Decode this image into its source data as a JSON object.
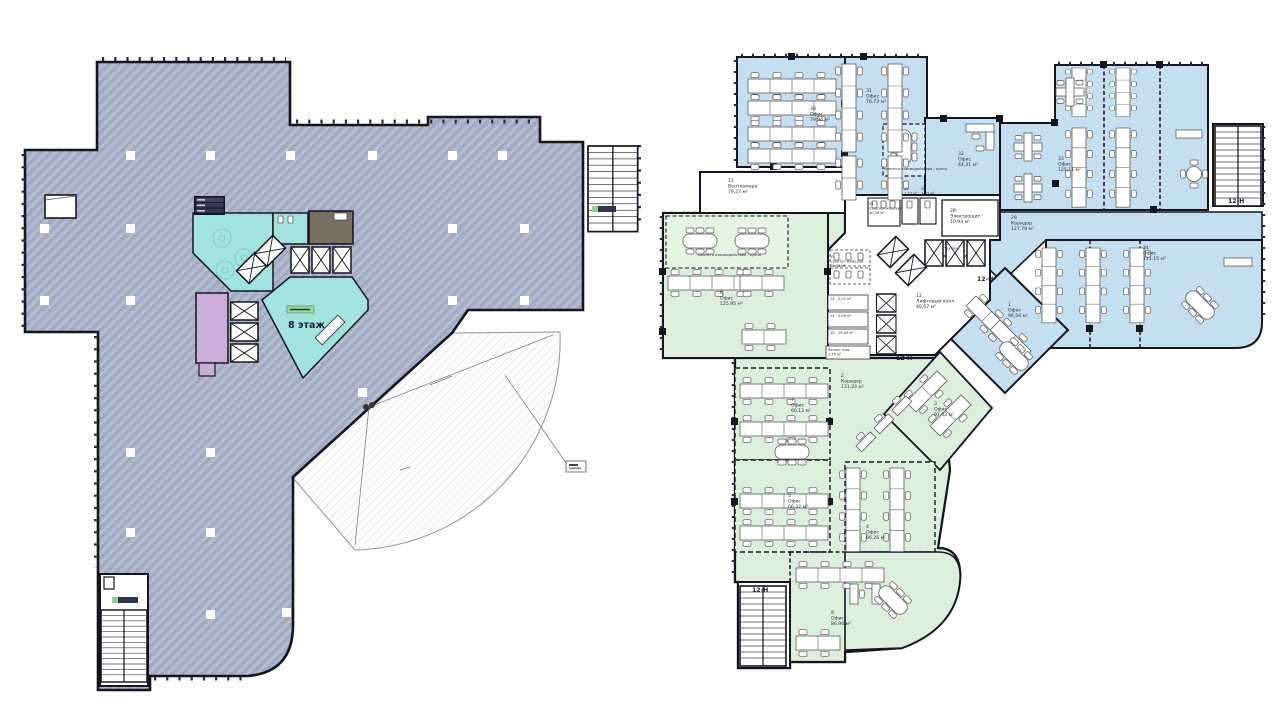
{
  "left_plan": {
    "floor_label": "8 этаж",
    "colors": {
      "body": "#a9b2c8",
      "lobby_teal": "#a2e3dd",
      "room_purple": "#c9afd8",
      "room_brown": "#7b6f64",
      "badge_green": "#98d7a2"
    }
  },
  "right_plan": {
    "colors": {
      "office_blue": "#c6dff0",
      "office_green": "#dcefdc"
    },
    "block_label": "12-Н",
    "meeting_label": "комната взаимодействия / кухня",
    "rooms": {
      "r30": {
        "num": "30",
        "name": "Офис",
        "area": "79,96 м²"
      },
      "r31": {
        "num": "31",
        "name": "Офис",
        "area": "76,73 м²"
      },
      "r32": {
        "num": "32",
        "name": "Офис",
        "area": "44,31 м²"
      },
      "r33": {
        "num": "33",
        "name": "Офис",
        "area": "125,11 м²"
      },
      "r34": {
        "num": "34",
        "name": "Офис",
        "area": "111,15 м²"
      },
      "r29": {
        "num": "29",
        "name": "Коридор",
        "area": "127,79 м²"
      },
      "r11": {
        "num": "11",
        "name": "Венткамера",
        "area": "79,27 м²"
      },
      "r24": {
        "num": "24",
        "name": "Санузел женский",
        "area": "10,16 м²"
      },
      "r25": {
        "num": "25",
        "name": "",
        "area": "1,73 м²"
      },
      "r26": {
        "num": "26",
        "name": "",
        "area": "1,73 м²"
      },
      "r28": {
        "num": "28",
        "name": "Электрощит.",
        "area": "10,94 м²"
      },
      "r27": {
        "num": "27",
        "name": "Тех.пом.",
        "area": ""
      },
      "r12": {
        "num": "12",
        "name": "Лифтовый холл",
        "area": "49,67 м²"
      },
      "r15": {
        "num": "15",
        "name": "Санузел мужской",
        "area": "10,49 м²"
      },
      "r14": {
        "num": "14",
        "name": "",
        "area": "2,01 м²"
      },
      "r13": {
        "num": "13",
        "name": "",
        "area": "2,09 м²"
      },
      "r10": {
        "num": "10",
        "name": "",
        "area": "10,45 м²"
      },
      "rvsp": {
        "num": "",
        "name": "Вспом. пом.",
        "area": "1,79 м²"
      },
      "r6": {
        "num": "6",
        "name": "Офис",
        "area": "125,95 м²"
      },
      "r2": {
        "num": "2",
        "name": "Коридор",
        "area": "131,24 м²"
      },
      "r7": {
        "num": "7",
        "name": "Офис",
        "area": "60,12 м²"
      },
      "r5": {
        "num": "5",
        "name": "Офис",
        "area": "66,32 м²"
      },
      "r4": {
        "num": "4",
        "name": "Офис",
        "area": "66,26 м²"
      },
      "r8": {
        "num": "8",
        "name": "Офис",
        "area": "86,96 м²"
      },
      "r3": {
        "num": "3",
        "name": "Офис",
        "area": "97,02 м²"
      },
      "r1": {
        "num": "1",
        "name": "Офис",
        "area": "96,56 м²"
      }
    }
  }
}
